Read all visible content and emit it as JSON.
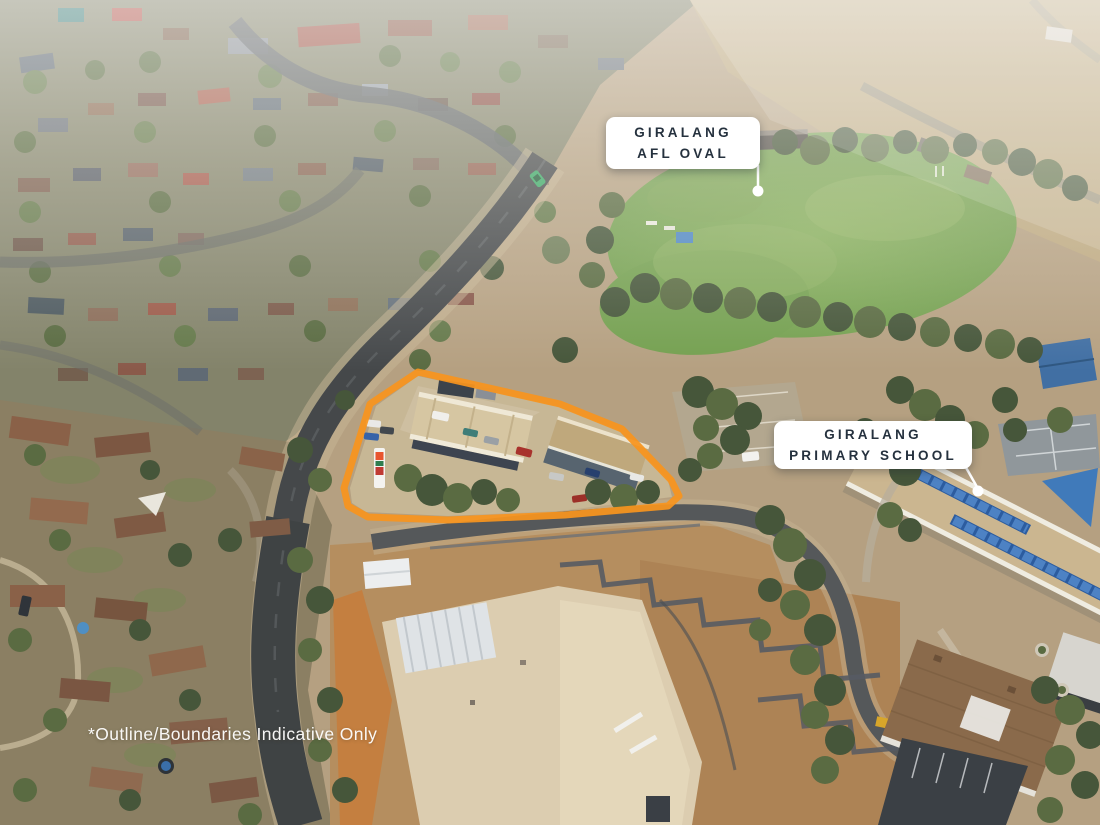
{
  "annotations": {
    "afl_oval_label": {
      "line1": "GIRALANG",
      "line2": "AFL OVAL"
    },
    "primary_school_label": {
      "line1": "GIRALANG",
      "line2": "PRIMARY SCHOOL"
    },
    "disclaimer": "*Outline/Boundaries Indicative Only",
    "colors": {
      "property_outline": "#F7941E",
      "label_background": "#FFFFFF",
      "label_text": "#25313E",
      "pointer": "#FFFFFF"
    }
  }
}
